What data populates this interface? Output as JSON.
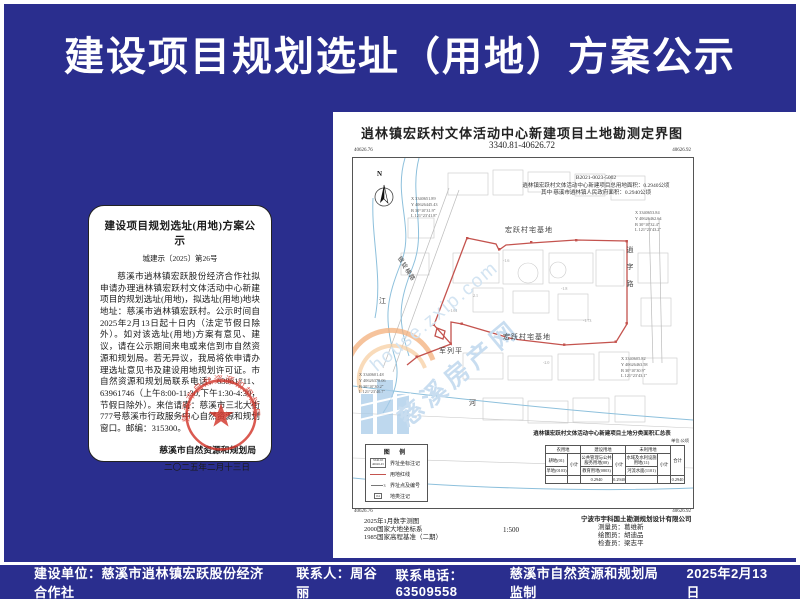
{
  "colors": {
    "background_blue": "#2A2E8E",
    "boundary_red": "#C4534E",
    "seal_red": "#D3362B",
    "watermark_blue": "#C8DDF0",
    "stream_blue": "#8DC0DC"
  },
  "banner": {
    "title": "建设项目规划选址（用地）方案公示"
  },
  "notice": {
    "title": "建设项目规划选址(用地)方案公示",
    "doc_no": "城建示〔2025〕第26号",
    "body": "慈溪市逍林镇宏跃股份经济合作社拟申请办理逍林镇宏跃村文体活动中心新建项目的规划选址(用地)，拟选址(用地)地块地址：慈溪市逍林镇宏跃村。公示时间自2025年2月13日起十日内（法定节假日除外）。如对该选址(用地)方案有意见、建议，请在公示期间来电或来信到市自然资源和规划局。若无异议，我局将依申请办理选址意见书及建设用地规划许可证。市自然资源和规划局联系电话：63961711、63961746（上午8:00-11:30,下午1:30-4:30，节假日除外）。来信请寄：慈溪市三北大街777号慈溪市行政服务中心自然资源和规划窗口。邮编：315300。",
    "signature": "慈溪市自然资源和规划局",
    "date": "二〇二五年二月十三日",
    "seal_text": "慈溪市自然资源和规划局"
  },
  "map": {
    "title": "逍林镇宏跃村文体活动中心新建项目土地勘测定界图",
    "sheet_no": "3340.81-40626.72",
    "project_code": "B2021-0023-5002",
    "annotation_line1": "逍林镇宏跃村文体活动中心新建项目总用地面积：0.2940公顷",
    "annotation_line2": "其中  慈溪市逍林镇人民政府面积：0.2940公顷",
    "corners": {
      "tl_x": "40626.76",
      "tl_y": "3340.94",
      "tr_x": "40626.92",
      "tr_y": "3340.94",
      "bl_y": "3340.91",
      "bl_x": "40626.76",
      "br_y": "3340.91",
      "br_x": "40626.92"
    },
    "labels": {
      "north": "N",
      "parcel_top": "宏跃村宅基地",
      "parcel_bottom": "宏跃村宅基地",
      "house": "军列平",
      "river_left": "江",
      "river_bottom": "河",
      "road_right": "逍字路",
      "road_diag": "银锭横路"
    },
    "callouts": [
      [
        "X 3340651.89",
        "Y 40626445.43",
        "B 30°10′31.9″",
        "L 121°23′41.8″"
      ],
      [
        "X 3340653.84",
        "Y 40626462.64",
        "B 30°10′32.4″",
        "L 121°23′43.2″"
      ],
      [
        "X 3340605.82",
        "Y 40626463.58",
        "B 30°10′30.9″",
        "L 121°23′43.1″"
      ],
      [
        "X 3340601.48",
        "Y 40626378.06",
        "B 30°10′30.2″",
        "L 121°23′40.7″"
      ]
    ],
    "spot_heights": [
      "-1.6",
      "-1.8",
      "2.1",
      "-1.73",
      "-1.61",
      "-2.0"
    ],
    "legend": {
      "title": "图  例",
      "items": [
        {
          "label": "界址坐标注记",
          "s1": "3340.65",
          "s2": "40626.45"
        },
        {
          "label": "用地红线"
        },
        {
          "label": "界址点及编号",
          "s1": "3"
        },
        {
          "label": "地类注记",
          "s1": "04"
        }
      ]
    },
    "area_table": {
      "title": "逍林镇宏跃村文体活动中心新建项目土地分类面积汇总表",
      "unit": "单位:公顷",
      "groups": {
        "g1": "农用地",
        "g2": "建设用地",
        "g3": "未利用地",
        "total": "合计",
        "subtotal": "小计"
      },
      "cells": {
        "g1r1": "耕地(01)",
        "g1r2": "旱地(0103)",
        "g2r1": "公共管理与公共服务用地(08)",
        "g2r2": "教育用地(0803)",
        "g3r1": "水域及水利设施用地(11)",
        "g3r2": "河流水面(1101)",
        "v_g2": "0.2940",
        "v_g2sub": "0.2940",
        "v_total": "0.2940"
      }
    },
    "notes_left": [
      "2025年1月数字测图",
      "2000国家大地坐标系",
      "1985国家高程基准（二期）"
    ],
    "scale": "1:500",
    "notes_right": [
      "宁波市宇科国土勘测规划设计有限公司",
      "测量员：葛维新",
      "绘图员：胡迪品",
      "检查员：梁志平"
    ],
    "watermark": {
      "text1": "house.zxip.com",
      "text2": "慈溪房产网"
    }
  },
  "footer": {
    "unit": "建设单位：慈溪市逍林镇宏跃股份经济合作社",
    "contact": "联系人：周谷丽",
    "phone": "联系电话：63509558",
    "supervisor": "慈溪市自然资源和规划局监制",
    "date": "2025年2月13日"
  }
}
